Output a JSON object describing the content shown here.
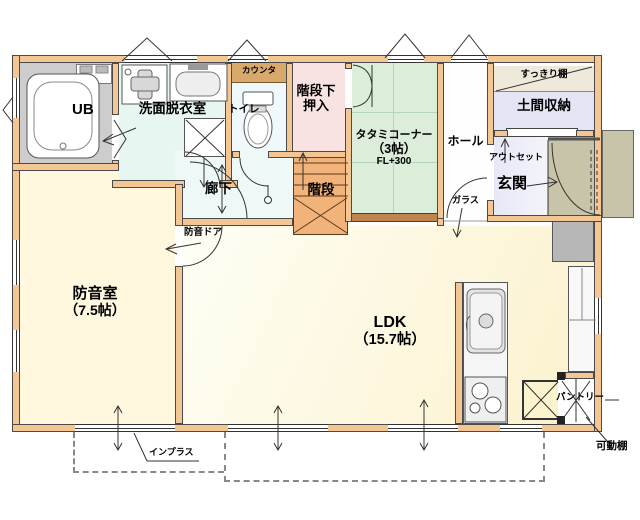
{
  "rooms": {
    "ub": {
      "label": "UB"
    },
    "washroom": {
      "label": "洗面脱衣室"
    },
    "toilet": {
      "label": "トイレ"
    },
    "counter": {
      "label": "カウンタ"
    },
    "understairs_closet": {
      "line1": "階段下",
      "line2": "押入"
    },
    "stairs": {
      "label": "階段"
    },
    "corridor": {
      "label": "廊下"
    },
    "tatami_corner": {
      "line1": "タタミコーナー",
      "line2": "（3帖）",
      "line3": "FL+300"
    },
    "hall": {
      "label": "ホール"
    },
    "clean_shelf": {
      "label": "すっきり棚"
    },
    "doma_storage": {
      "label": "土間収納"
    },
    "entrance": {
      "label": "玄関"
    },
    "soundproof_room": {
      "line1": "防音室",
      "line2": "（7.5帖）"
    },
    "ldk": {
      "line1": "LDK",
      "line2": "（15.7帖）"
    },
    "pantry": {
      "label": "パントリー"
    }
  },
  "annotations": {
    "outset": "アウトセット",
    "glass": "ガラス",
    "soundproof_door": "防音ドア",
    "inner_window": "インプラス",
    "movable_shelf": "可動棚"
  },
  "colors": {
    "wall": "#F4C693",
    "tatami": "#DCEDDA",
    "soundproof_room": "#FFF8DF",
    "ldk": "#FBF1CC",
    "closet_pink": "#F9E2E2",
    "doma_lavender": "#E3E5F5",
    "porch": "#C8C4A9",
    "stairs": "#F1B379",
    "bath_floor": "#CDCDCD",
    "washroom": "#E7F6F1",
    "wood_counter": "#D9A96B"
  }
}
